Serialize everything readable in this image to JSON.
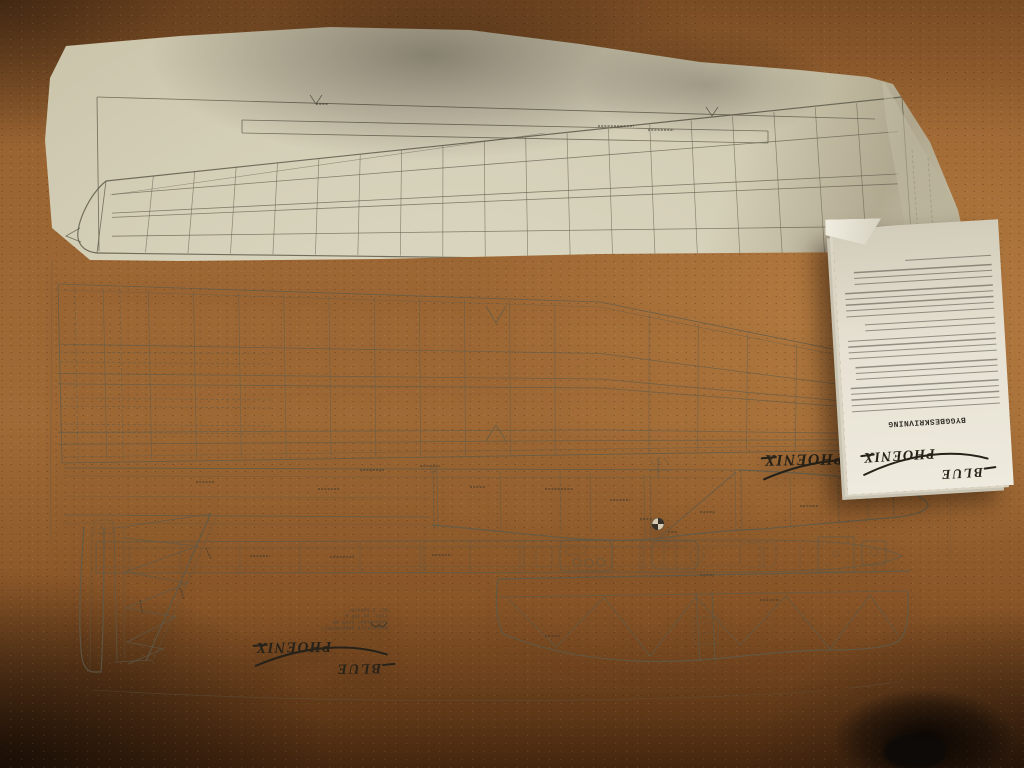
{
  "plan_sheet": {
    "logo": {
      "word1": "BLUE",
      "word2": "PHOENIX"
    },
    "spec_block": {
      "lines": [
        "Radiostyrd segelmodell",
        "Spännvidd: 2540 mm",
        "Vikt: ca 750 g",
        "RC: 2 kanaler"
      ]
    }
  },
  "booklet": {
    "heading": "BYGGBESKRIVNING",
    "logo": {
      "word1": "BLUE",
      "word2": "PHOENIX"
    }
  },
  "colors": {
    "floor_cork": "#9a6432",
    "floor_shadow": "#44260f",
    "paper_plan": "#e4dfc8",
    "paper_booklet": "#e9e5d8",
    "drawing_ink": "#5d5a4a",
    "logo_ink": "#262219"
  }
}
